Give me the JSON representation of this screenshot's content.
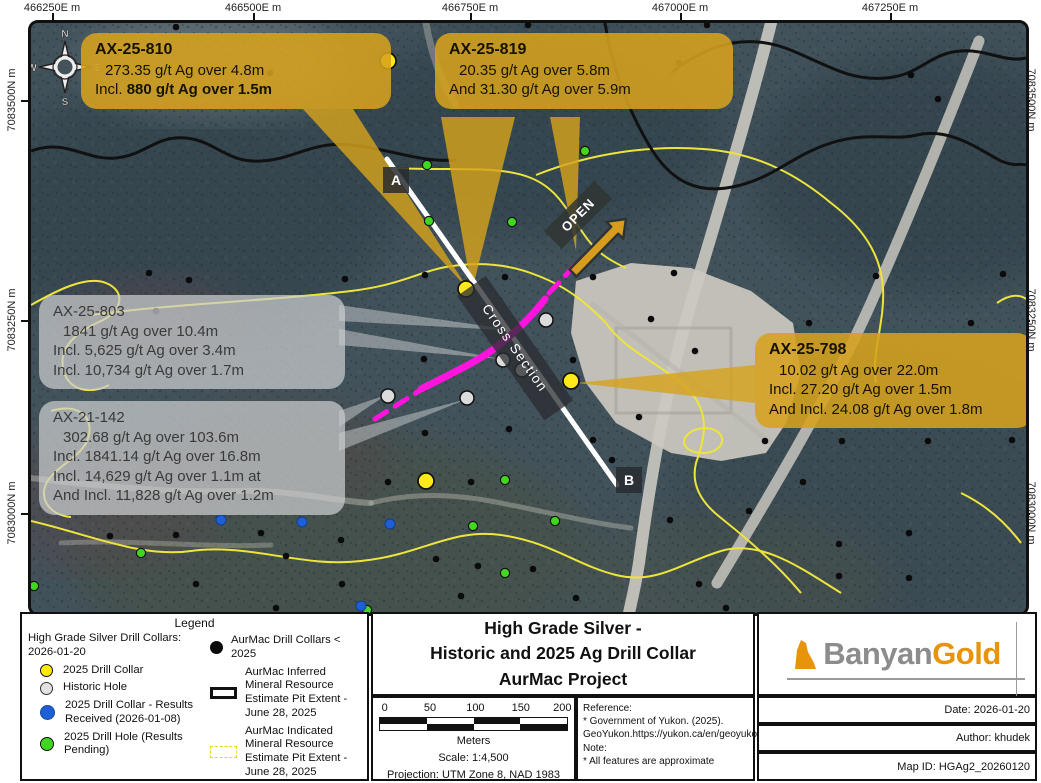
{
  "map": {
    "coordinates": {
      "top": [
        "466250E m",
        "466500E m",
        "466750E m",
        "467000E m",
        "467250E m"
      ],
      "left": [
        "7083500N m",
        "7083250N m",
        "7083000N m"
      ],
      "right": [
        "7083500N m",
        "7083250N m",
        "7083000N m"
      ]
    },
    "compass": {
      "n": "N",
      "e": "E",
      "s": "S",
      "w": "W"
    },
    "labels": {
      "section_a": "A",
      "section_b": "B",
      "cross_section": "Cross Section",
      "open": "OPEN"
    },
    "callouts": {
      "ax25810": {
        "title": "AX-25-810",
        "line1": "273.35 g/t Ag over 4.8m",
        "line2_prefix": "Incl.  ",
        "line2_bold": "880 g/t Ag over 1.5m"
      },
      "ax25819": {
        "title": "AX-25-819",
        "line1": "20.35 g/t Ag over 5.8m",
        "line2": "And 31.30 g/t Ag over 5.9m"
      },
      "ax25798": {
        "title": "AX-25-798",
        "line1": "10.02 g/t Ag over 22.0m",
        "line2": "Incl. 27.20 g/t Ag over 1.5m",
        "line3": "And Incl. 24.08 g/t Ag over 1.8m"
      },
      "ax25803": {
        "title": "AX-25-803",
        "line1": "1841 g/t Ag over 10.4m",
        "line2": "Incl. 5,625 g/t Ag over 3.4m",
        "line3": "Incl. 10,734 g/t Ag over 1.7m"
      },
      "ax21142": {
        "title": "AX-21-142",
        "line1": "302.68 g/t Ag over 103.6m",
        "line2": "Incl. 1841.14 g/t Ag over 16.8m",
        "line3": "Incl. 14,629 g/t Ag over 1.1m at",
        "line4": "And Incl. 11,828 g/t Ag over 1.2m"
      }
    },
    "collars": {
      "yellow": [
        [
          357,
          38
        ],
        [
          435,
          266
        ],
        [
          540,
          358
        ],
        [
          395,
          458
        ]
      ],
      "historic": [
        [
          515,
          297
        ],
        [
          472,
          337
        ],
        [
          491,
          347
        ],
        [
          357,
          373
        ],
        [
          436,
          375
        ]
      ],
      "blue": [
        [
          190,
          497
        ],
        [
          271,
          499
        ],
        [
          359,
          501
        ],
        [
          330,
          583
        ]
      ],
      "green": [
        [
          396,
          142
        ],
        [
          398,
          198
        ],
        [
          554,
          128
        ],
        [
          481,
          199
        ],
        [
          110,
          530
        ],
        [
          474,
          457
        ],
        [
          442,
          503
        ],
        [
          524,
          498
        ],
        [
          474,
          550
        ],
        [
          336,
          587
        ],
        [
          3,
          563
        ]
      ],
      "black": [
        [
          145,
          4
        ],
        [
          497,
          2
        ],
        [
          676,
          2
        ],
        [
          239,
          50
        ],
        [
          648,
          40
        ],
        [
          880,
          52
        ],
        [
          907,
          76
        ],
        [
          118,
          250
        ],
        [
          158,
          257
        ],
        [
          125,
          288
        ],
        [
          314,
          256
        ],
        [
          394,
          252
        ],
        [
          474,
          254
        ],
        [
          562,
          254
        ],
        [
          643,
          250
        ],
        [
          845,
          253
        ],
        [
          972,
          251
        ],
        [
          620,
          296
        ],
        [
          664,
          328
        ],
        [
          778,
          300
        ],
        [
          940,
          300
        ],
        [
          393,
          336
        ],
        [
          542,
          337
        ],
        [
          608,
          394
        ],
        [
          478,
          406
        ],
        [
          394,
          410
        ],
        [
          562,
          417
        ],
        [
          357,
          459
        ],
        [
          440,
          459
        ],
        [
          581,
          437
        ],
        [
          734,
          418
        ],
        [
          811,
          418
        ],
        [
          897,
          418
        ],
        [
          981,
          417
        ],
        [
          79,
          513
        ],
        [
          145,
          512
        ],
        [
          230,
          510
        ],
        [
          310,
          517
        ],
        [
          255,
          533
        ],
        [
          165,
          561
        ],
        [
          311,
          561
        ],
        [
          405,
          536
        ],
        [
          447,
          543
        ],
        [
          502,
          546
        ],
        [
          639,
          497
        ],
        [
          718,
          488
        ],
        [
          772,
          459
        ],
        [
          878,
          510
        ],
        [
          808,
          521
        ],
        [
          668,
          561
        ],
        [
          808,
          553
        ],
        [
          878,
          555
        ],
        [
          245,
          585
        ],
        [
          430,
          573
        ],
        [
          695,
          585
        ],
        [
          545,
          575
        ]
      ]
    }
  },
  "legend": {
    "title": "Legend",
    "left_header": "High Grade Silver Drill Collars: 2026-01-20",
    "items_left": [
      {
        "label": "2025 Drill Collar"
      },
      {
        "label": "Historic Hole"
      },
      {
        "label": "2025 Drill Collar - Results Received (2026-01-08)"
      },
      {
        "label": "2025 Drill Hole (Results Pending)"
      }
    ],
    "items_right": [
      {
        "label": "AurMac Drill Collars < 2025"
      },
      {
        "label": "AurMac Inferred Mineral Resource Estimate Pit Extent - June 28, 2025"
      },
      {
        "label": "AurMac Indicated Mineral Resource Estimate Pit Extent - June 28, 2025"
      },
      {
        "label": "AurMac Project Boundary"
      }
    ]
  },
  "title_block": {
    "line1": "High Grade Silver -",
    "line2": "Historic and 2025 Ag Drill Collar",
    "line3": "AurMac Project"
  },
  "scale_bar": {
    "ticks": [
      "0",
      "50",
      "100",
      "150",
      "200"
    ],
    "unit": "Meters",
    "scale": "Scale: 1:4,500",
    "projection": "Projection: UTM Zone 8, NAD 1983"
  },
  "reference": {
    "heading": "Reference:",
    "line1": "* Government of Yukon. (2025).",
    "line2": "GeoYukon.https://yukon.ca/en/geoyukon",
    "note_heading": "Note:",
    "note_line": "* All features are approximate"
  },
  "credits": {
    "logo_part1": "Banyan",
    "logo_part2": "Gold",
    "date": "Date: 2026-01-20",
    "author": "Author: khudek",
    "map_id": "Map ID: HGAg2_20260120"
  },
  "colors": {
    "callout_gold": "#D7A41E",
    "callout_gray": "#C9CCCE",
    "mineral_trend_magenta": "#FF14DF",
    "section_line_white": "#FFFFFF",
    "inferred_pit_black": "#111111",
    "indicated_pit_yellow": "#EDE53A",
    "project_boundary_orange": "#F0991E",
    "collar_yellow": "#FFE91A",
    "collar_historic": "#DBDBDB",
    "collar_blue": "#1E5FD6",
    "collar_green": "#3FD81E",
    "collar_black": "#0B0B0B",
    "logo_gray": "#8C8C8C",
    "logo_orange": "#E8940A"
  }
}
